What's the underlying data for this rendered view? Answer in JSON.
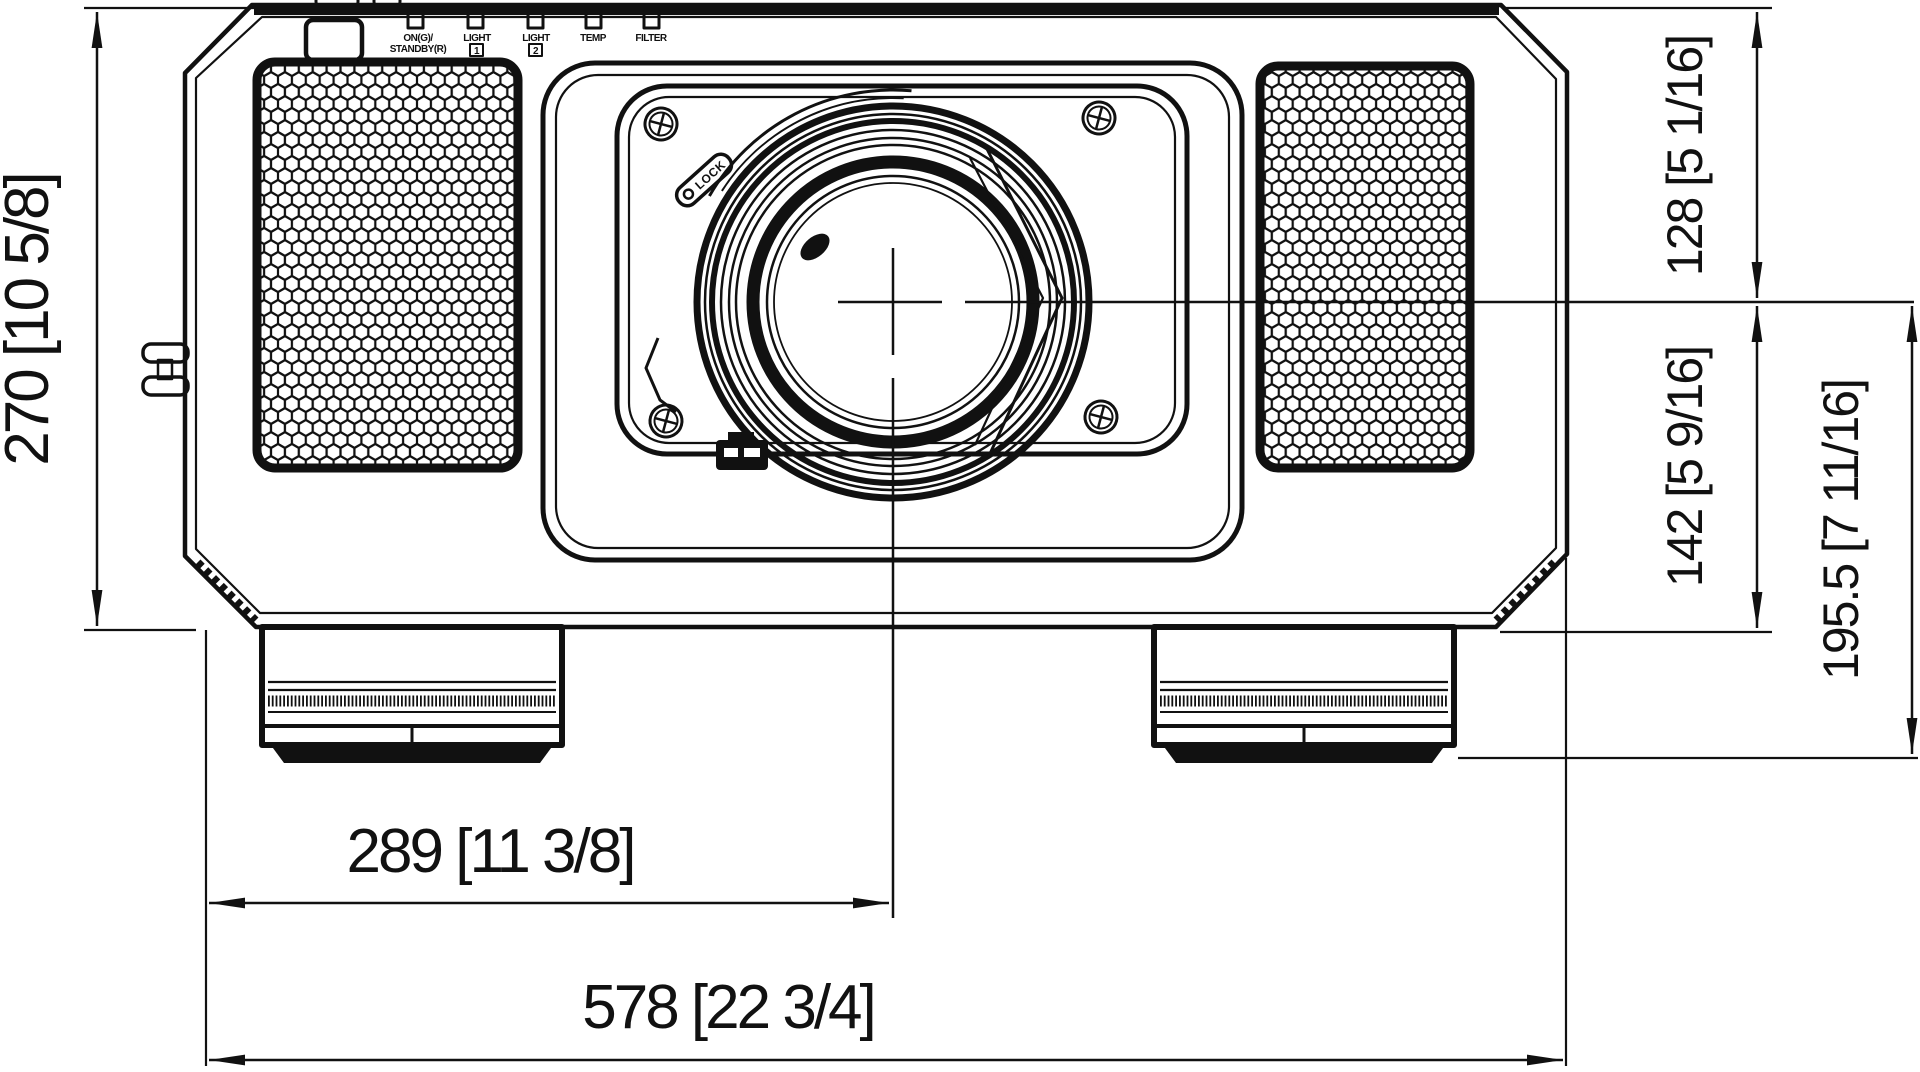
{
  "title": "projector-front-dimension-drawing",
  "colors": {
    "ink": "#111111",
    "paper": "#ffffff"
  },
  "indicators": {
    "power_line1": "ON(G)/",
    "power_line2": "STANDBY(R)",
    "light1_label": "LIGHT",
    "light1_num": "1",
    "light2_label": "LIGHT",
    "light2_num": "2",
    "temp_label": "TEMP",
    "filter_label": "FILTER"
  },
  "lens": {
    "lock_label": "LOCK"
  },
  "dimensions": {
    "body_height": "270 [10 5/8]",
    "top_to_center": "128 [5 1/16]",
    "center_to_bottom": "142 [5 9/16]",
    "center_to_foot": "195.5 [7 11/16]",
    "left_to_center": "289 [11 3/8]",
    "body_width": "578 [22 3/4]"
  }
}
